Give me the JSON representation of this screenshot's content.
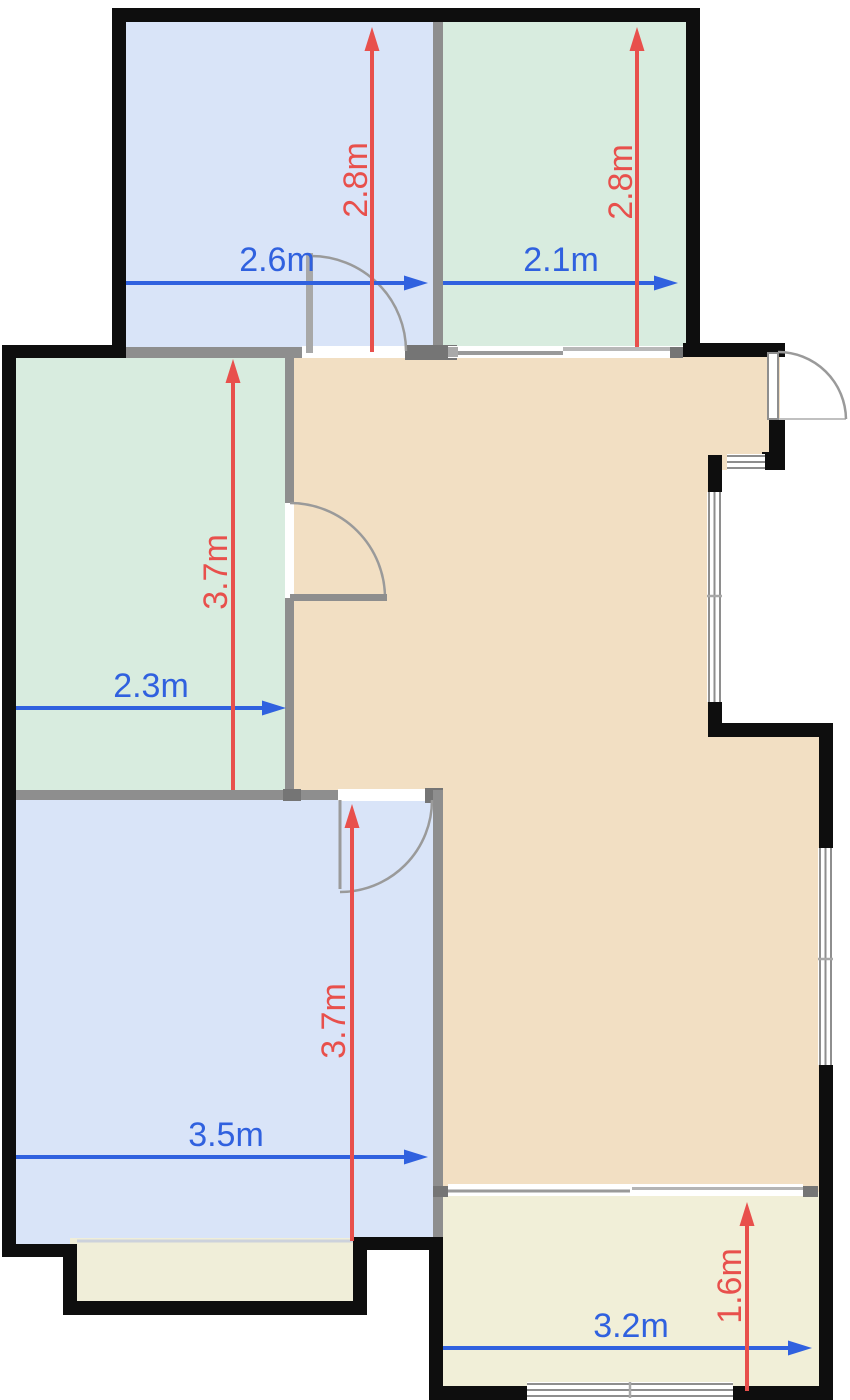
{
  "colors": {
    "background": "#FFFFFF",
    "wall": "#0E0E0E",
    "interior_wall": "#8E8E8E",
    "interior_wall_dark": "#757575",
    "window_line": "#8E8E8E",
    "door_arc": "#9A9A9A",
    "room_blue": "#D9E4F8",
    "room_green": "#D8ECDF",
    "hall_beige": "#F2DFC3",
    "room_cream": "#F1EFD8",
    "balcony_cream": "#F0EED9",
    "dim_blue": "#3061DF",
    "dim_red": "#E8504C"
  },
  "dimensions": {
    "top_left_width": "2.6m",
    "top_left_height": "2.8m",
    "top_right_width": "2.1m",
    "top_right_height": "2.8m",
    "middle_left_width": "2.3m",
    "middle_left_height": "3.7m",
    "bottom_left_width": "3.5m",
    "bottom_left_height": "3.7m",
    "bottom_right_width": "3.2m",
    "bottom_right_height": "1.6m"
  }
}
